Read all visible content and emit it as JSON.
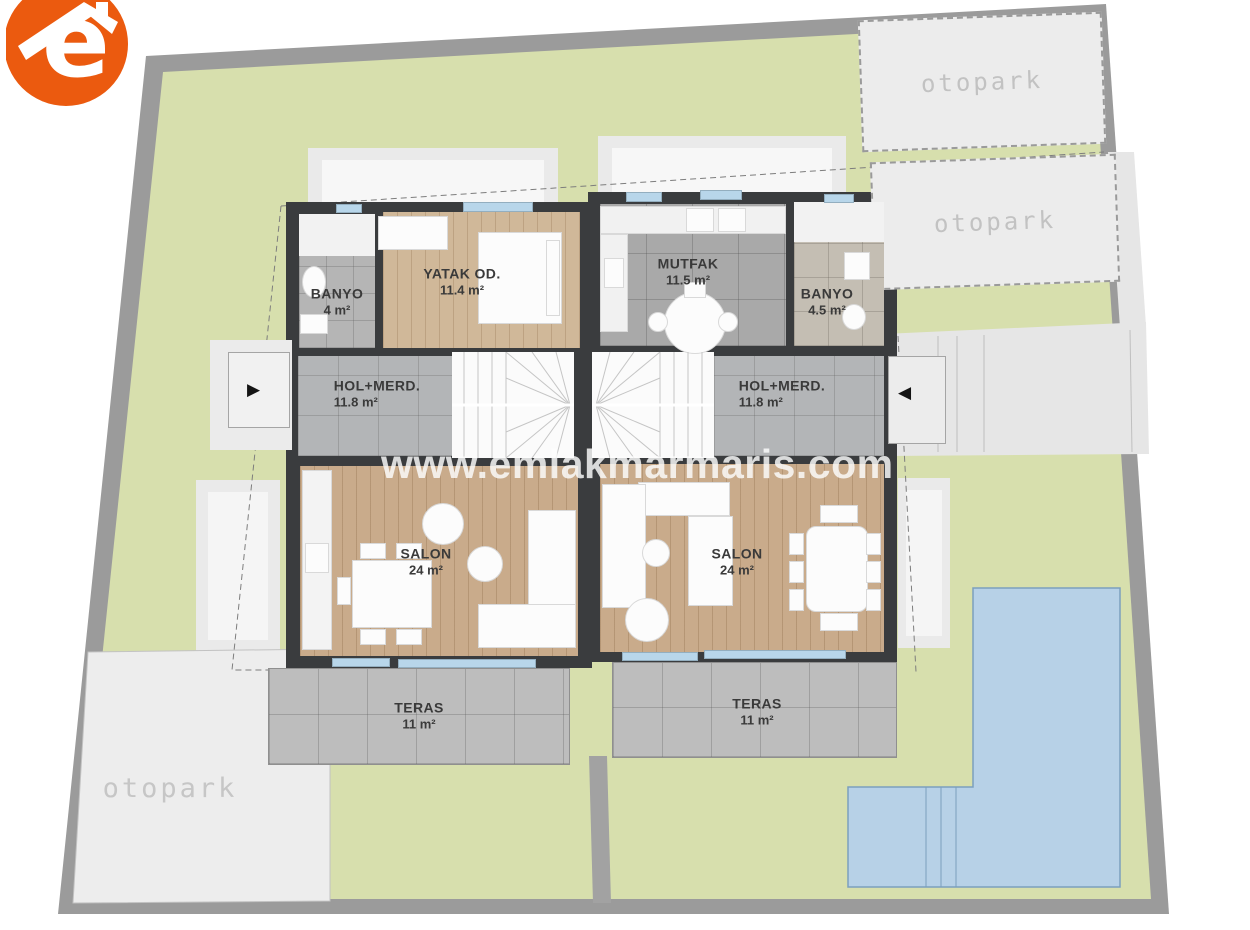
{
  "logo": {
    "letter": "e",
    "color": "#eb5a0f"
  },
  "watermark": {
    "text": "www.emlakmarmaris.com"
  },
  "parking": {
    "top": "otopark",
    "mid": "otopark",
    "bottom": "otopark"
  },
  "arrows": {
    "left": "▶",
    "right": "◀"
  },
  "rooms": {
    "banyo_a": {
      "name": "BANYO",
      "area": "4 m²"
    },
    "yatak_a": {
      "name": "YATAK OD.",
      "area": "11.4 m²"
    },
    "hol_a": {
      "name": "HOL+MERD.",
      "area": "11.8 m²"
    },
    "salon_a": {
      "name": "SALON",
      "area": "24 m²"
    },
    "teras_a": {
      "name": "TERAS",
      "area": "11 m²"
    },
    "mutfak_b": {
      "name": "MUTFAK",
      "area": "11.5 m²"
    },
    "banyo_b": {
      "name": "BANYO",
      "area": "4.5 m²"
    },
    "hol_b": {
      "name": "HOL+MERD.",
      "area": "11.8 m²"
    },
    "salon_b": {
      "name": "SALON",
      "area": "24 m²"
    },
    "teras_b": {
      "name": "TERAS",
      "area": "11 m²"
    }
  },
  "colors": {
    "lawn": "#d7dfad",
    "road": "#9b9b9b",
    "pool": "#b7d1e7",
    "wall": "#3a3c3e",
    "wood": "#c9ab8b",
    "window": "#b8d6ea",
    "logo_orange": "#eb5a0f"
  }
}
